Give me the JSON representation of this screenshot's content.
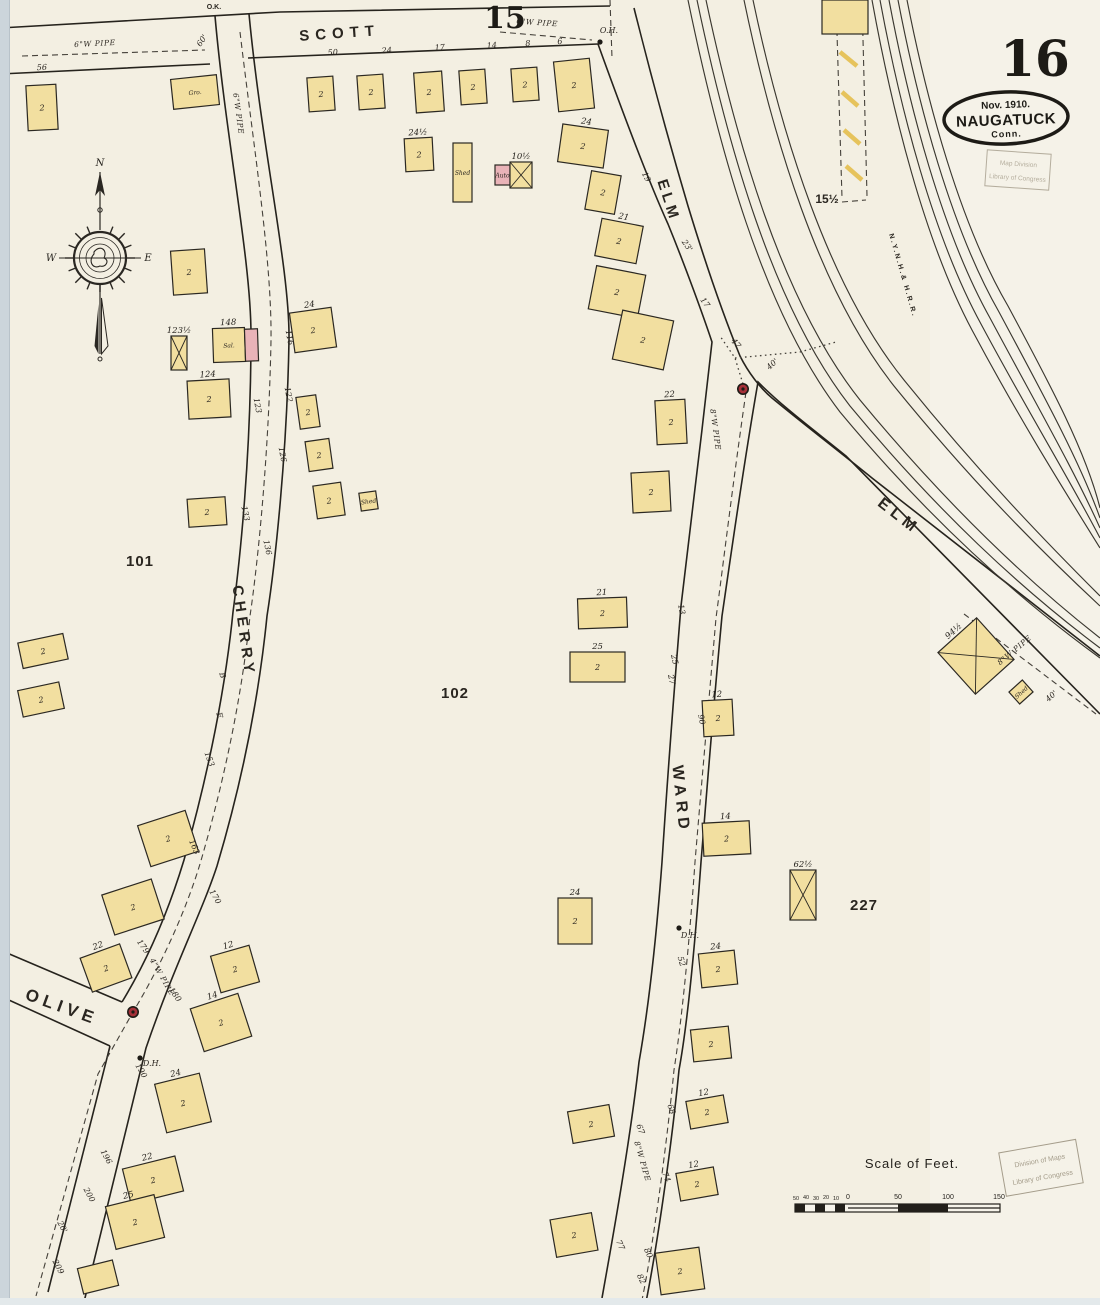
{
  "sheet": {
    "number": "16",
    "adjacent_top": "15",
    "adjacent_right_block": "15½",
    "corner_note": "O.K."
  },
  "publisher_oval": {
    "date": "Nov. 1910.",
    "city": "NAUGATUCK",
    "state": "Conn."
  },
  "stamps": {
    "top": {
      "line1": "Map Division",
      "line2": "Library of Congress"
    },
    "bottom": {
      "line1": "Division of Maps",
      "line2": "Library of Congress"
    }
  },
  "scale_bar": {
    "title": "Scale of Feet.",
    "ticks": [
      "50",
      "40",
      "30",
      "20",
      "10",
      "0",
      "50",
      "100",
      "150"
    ]
  },
  "compass": {
    "north": "N",
    "west": "W",
    "east": "E"
  },
  "colors": {
    "paper": "#f3efe2",
    "paper_light": "#f6f3ea",
    "frame_yellow": "#f2dfa0",
    "brick_pink": "#e9b3b8",
    "hydrant_red": "#a53038",
    "ink": "#26231d",
    "hatch_yellow": "#e6c35c",
    "edge_strip": "#ccd5db",
    "stamp_ink": "#a59d8b"
  },
  "map": {
    "block_numbers": [
      "101",
      "102",
      "227"
    ],
    "street_names": [
      "SCOTT",
      "CHERRY",
      "ELM",
      "WARD",
      "OLIVE"
    ],
    "railroad_name": "N.Y.N.H.& H.R.R.",
    "lines": [
      {
        "n": "sheet-15-edge-line",
        "c": "st",
        "d": "M0,28 L280,12 L610,6"
      },
      {
        "n": "scott-south-edge",
        "c": "st",
        "d": "M0,74 L210,64 M248,58 L598,44"
      },
      {
        "n": "cherry-west-edge",
        "c": "st",
        "d": "M215,16 C226,140 251,260 251,335 C251,455 240,560 233,612 C225,692 207,778 184,860 C170,906 150,956 122,1002"
      },
      {
        "n": "cherry-west-edge-lower",
        "c": "st",
        "d": "M110,1046 L48,1292"
      },
      {
        "n": "cherry-east-edge",
        "c": "st",
        "d": "M249,14 C262,150 290,270 289,340 C287,455 275,565 267,616 C259,696 242,782 217,866 C202,912 174,966 146,1048 L84,1302"
      },
      {
        "n": "olive-north-edge",
        "c": "st",
        "d": "M0,950 L122,1002"
      },
      {
        "n": "olive-south-edge",
        "c": "st",
        "d": "M0,996 L110,1046"
      },
      {
        "n": "elm-west-ward-west-edge",
        "c": "st",
        "d": "M598,44 C620,105 648,180 668,224 C686,268 704,318 712,342 C702,432 688,548 681,606 C672,716 666,800 662,862 C655,956 646,1022 639,1062 C630,1142 612,1242 602,1298"
      },
      {
        "n": "elm-east-edge",
        "c": "st",
        "d": "M634,8 C652,80 672,152 688,206 C702,252 722,312 740,356 C748,372 760,388 772,398 C806,426 840,452 872,478 L1100,656"
      },
      {
        "n": "elm-southwest-ward-east-edge",
        "c": "st",
        "d": "M1100,714 L846,456 C814,430 784,408 758,382 C742,474 730,562 722,616 C712,722 706,802 701,862 C694,958 686,1032 679,1070 C671,1152 656,1252 646,1302"
      },
      {
        "n": "rail-track",
        "c": "rail",
        "d": "M688,0 C718,145 762,310 840,412 C930,520 1015,596 1100,658"
      },
      {
        "n": "rail-track",
        "c": "rail",
        "d": "M697,0 C727,143 772,306 850,406 C938,512 1020,588 1100,648"
      },
      {
        "n": "rail-track",
        "c": "rail",
        "d": "M706,0 C736,141 782,302 860,400 C946,504 1026,580 1100,638"
      },
      {
        "n": "rail-track",
        "c": "rail",
        "d": "M744,0 C772,135 818,290 894,386 C972,482 1040,550 1100,606"
      },
      {
        "n": "rail-track",
        "c": "rail",
        "d": "M753,0 C781,133 828,286 904,380 C980,474 1046,542 1100,596"
      },
      {
        "n": "rail-track",
        "c": "rail",
        "d": "M872,0 C892,110 924,240 972,330 C1020,420 1064,490 1100,548"
      },
      {
        "n": "rail-track",
        "c": "rail",
        "d": "M880,0 C900,108 933,236 981,324 C1028,412 1070,480 1100,538"
      },
      {
        "n": "rail-track",
        "c": "rail",
        "d": "M889,0 C909,106 942,232 990,318 C1036,404 1074,470 1100,528"
      },
      {
        "n": "rail-track",
        "c": "rail",
        "d": "M898,0 C918,104 951,228 999,312 C1044,396 1080,462 1100,518"
      },
      {
        "n": "rail-track",
        "c": "rail",
        "d": "M907,0 C927,102 960,224 1008,306 C1052,388 1086,452 1100,508"
      },
      {
        "n": "water-pipe",
        "c": "pipe",
        "d": "M22,56 L205,50"
      },
      {
        "n": "water-pipe",
        "c": "pipe",
        "d": "M500,32 L592,40"
      },
      {
        "n": "water-pipe-cherry",
        "c": "pipe",
        "d": "M240,32 C254,150 272,262 271,340 C269,452 258,562 250,616 C242,696 224,782 200,864 C186,910 162,964 133,1012 L98,1074 L36,1296"
      },
      {
        "n": "water-pipe-ward",
        "c": "pipe",
        "d": "M746,392 C733,482 723,566 716,618 C707,722 700,802 695,862 C688,962 680,1032 674,1070 C666,1152 652,1252 642,1300"
      },
      {
        "n": "water-pipe-elm",
        "c": "pipe",
        "d": "M964,614 L1096,714"
      },
      {
        "n": "dotted-line",
        "c": "dotl",
        "d": "M743,384 L735,358 L720,336"
      },
      {
        "n": "dotted-line",
        "c": "dotl",
        "d": "M735,358 L800,352 L836,342"
      },
      {
        "n": "trestle-dashed-edge",
        "c": "pipe",
        "d": "M836,0 L842,198"
      },
      {
        "n": "trestle-dashed-edge",
        "c": "pipe",
        "d": "M862,0 L867,196 M842,202 L866,200"
      },
      {
        "n": "dashed-line-top",
        "c": "pipe",
        "d": "M610,0 L612,58"
      }
    ],
    "trestle_hatches": [
      [
        839,
        14,
        856,
        28
      ],
      [
        840,
        52,
        857,
        66
      ],
      [
        842,
        92,
        858,
        106
      ],
      [
        844,
        130,
        860,
        144
      ],
      [
        846,
        166,
        862,
        180
      ]
    ],
    "buildings": [
      {
        "x": 27,
        "y": 85,
        "w": 30,
        "h": 45,
        "r": -3,
        "s": "2"
      },
      {
        "x": 172,
        "y": 77,
        "w": 46,
        "h": 30,
        "r": -6,
        "li": "Gro."
      },
      {
        "x": 308,
        "y": 77,
        "w": 26,
        "h": 34,
        "r": -4,
        "s": "2"
      },
      {
        "x": 358,
        "y": 75,
        "w": 26,
        "h": 34,
        "r": -4,
        "s": "2"
      },
      {
        "x": 415,
        "y": 72,
        "w": 28,
        "h": 40,
        "r": -4,
        "s": "2"
      },
      {
        "x": 460,
        "y": 70,
        "w": 26,
        "h": 34,
        "r": -4,
        "s": "2"
      },
      {
        "x": 512,
        "y": 68,
        "w": 26,
        "h": 33,
        "r": -4,
        "s": "2"
      },
      {
        "x": 556,
        "y": 60,
        "w": 36,
        "h": 50,
        "r": -6,
        "s": "2"
      },
      {
        "x": 822,
        "y": 0,
        "w": 46,
        "h": 34,
        "r": 0
      },
      {
        "x": 405,
        "y": 138,
        "w": 28,
        "h": 33,
        "r": -3,
        "lb": "24½",
        "s": "2"
      },
      {
        "x": 453,
        "y": 143,
        "w": 19,
        "h": 59,
        "r": 0,
        "li": "Shed"
      },
      {
        "x": 495,
        "y": 165,
        "w": 15,
        "h": 20,
        "r": 0,
        "p": 1,
        "li": "Auto"
      },
      {
        "x": 510,
        "y": 162,
        "w": 22,
        "h": 26,
        "r": 0,
        "xm": 1,
        "lb": "10½"
      },
      {
        "x": 560,
        "y": 127,
        "w": 46,
        "h": 38,
        "r": 8,
        "s": "2",
        "lb": "24"
      },
      {
        "x": 588,
        "y": 173,
        "w": 30,
        "h": 39,
        "r": 10,
        "s": "2"
      },
      {
        "x": 598,
        "y": 222,
        "w": 42,
        "h": 38,
        "r": 11,
        "s": "2",
        "lb": "21"
      },
      {
        "x": 592,
        "y": 270,
        "w": 50,
        "h": 44,
        "r": 11,
        "s": "2"
      },
      {
        "x": 617,
        "y": 315,
        "w": 52,
        "h": 50,
        "r": 12,
        "s": "2"
      },
      {
        "x": 656,
        "y": 400,
        "w": 30,
        "h": 44,
        "r": -3,
        "s": "2",
        "lb": "22"
      },
      {
        "x": 632,
        "y": 472,
        "w": 38,
        "h": 40,
        "r": -3,
        "s": "2"
      },
      {
        "x": 172,
        "y": 250,
        "w": 34,
        "h": 44,
        "r": -4,
        "s": "2"
      },
      {
        "x": 171,
        "y": 336,
        "w": 16,
        "h": 34,
        "r": 0,
        "xm": 1,
        "lb": "123½"
      },
      {
        "x": 213,
        "y": 328,
        "w": 32,
        "h": 34,
        "r": -2,
        "li": "Sal.",
        "lb": "148"
      },
      {
        "x": 245,
        "y": 329,
        "w": 13,
        "h": 32,
        "r": -2,
        "p": 1
      },
      {
        "x": 188,
        "y": 380,
        "w": 42,
        "h": 38,
        "r": -3,
        "s": "2",
        "lb": "124"
      },
      {
        "x": 188,
        "y": 498,
        "w": 38,
        "h": 28,
        "r": -4,
        "s": "2"
      },
      {
        "x": 292,
        "y": 310,
        "w": 42,
        "h": 40,
        "r": -8,
        "s": "2",
        "lb": "24"
      },
      {
        "x": 298,
        "y": 396,
        "w": 20,
        "h": 32,
        "r": -8,
        "s": "2"
      },
      {
        "x": 307,
        "y": 440,
        "w": 24,
        "h": 30,
        "r": -8,
        "s": "2"
      },
      {
        "x": 315,
        "y": 484,
        "w": 28,
        "h": 33,
        "r": -8,
        "s": "2"
      },
      {
        "x": 360,
        "y": 492,
        "w": 17,
        "h": 18,
        "r": -8,
        "li": "Shed"
      },
      {
        "x": 578,
        "y": 598,
        "w": 49,
        "h": 30,
        "r": -2,
        "s": "2",
        "lb": "21"
      },
      {
        "x": 570,
        "y": 652,
        "w": 55,
        "h": 30,
        "r": 0,
        "s": "2",
        "lb": "25"
      },
      {
        "x": 703,
        "y": 700,
        "w": 30,
        "h": 36,
        "r": -3,
        "s": "2",
        "lb": "12"
      },
      {
        "x": 703,
        "y": 822,
        "w": 47,
        "h": 33,
        "r": -3,
        "s": "2",
        "lb": "14"
      },
      {
        "x": 790,
        "y": 870,
        "w": 26,
        "h": 50,
        "r": 0,
        "xm": 1,
        "lb": "62½"
      },
      {
        "x": 558,
        "y": 898,
        "w": 34,
        "h": 46,
        "r": 0,
        "s": "2",
        "lb": "24"
      },
      {
        "x": 700,
        "y": 952,
        "w": 36,
        "h": 34,
        "r": -6,
        "s": "2",
        "lb": "24"
      },
      {
        "x": 692,
        "y": 1028,
        "w": 38,
        "h": 32,
        "r": -6,
        "s": "2"
      },
      {
        "x": 688,
        "y": 1098,
        "w": 38,
        "h": 28,
        "r": -10,
        "s": "2",
        "lb": "12"
      },
      {
        "x": 678,
        "y": 1170,
        "w": 38,
        "h": 28,
        "r": -10,
        "s": "2",
        "lb": "12"
      },
      {
        "x": 658,
        "y": 1250,
        "w": 44,
        "h": 42,
        "r": -8,
        "s": "2"
      },
      {
        "x": 570,
        "y": 1108,
        "w": 42,
        "h": 32,
        "r": -10,
        "s": "2"
      },
      {
        "x": 553,
        "y": 1216,
        "w": 42,
        "h": 38,
        "r": -10,
        "s": "2"
      },
      {
        "x": 20,
        "y": 638,
        "w": 46,
        "h": 26,
        "r": -12,
        "s": "2"
      },
      {
        "x": 20,
        "y": 686,
        "w": 42,
        "h": 27,
        "r": -12,
        "s": "2"
      },
      {
        "x": 143,
        "y": 817,
        "w": 50,
        "h": 43,
        "r": -18,
        "s": "2"
      },
      {
        "x": 107,
        "y": 886,
        "w": 52,
        "h": 42,
        "r": -18,
        "s": "2"
      },
      {
        "x": 85,
        "y": 950,
        "w": 42,
        "h": 36,
        "r": -20,
        "s": "2",
        "lb": "22"
      },
      {
        "x": 215,
        "y": 950,
        "w": 40,
        "h": 38,
        "r": -16,
        "s": "2",
        "lb": "12"
      },
      {
        "x": 196,
        "y": 1000,
        "w": 50,
        "h": 45,
        "r": -18,
        "s": "2",
        "lb": "14"
      },
      {
        "x": 160,
        "y": 1078,
        "w": 46,
        "h": 50,
        "r": -14,
        "s": "2",
        "lb": "24"
      },
      {
        "x": 126,
        "y": 1162,
        "w": 54,
        "h": 36,
        "r": -14,
        "s": "2",
        "lb": "22"
      },
      {
        "x": 110,
        "y": 1200,
        "w": 50,
        "h": 44,
        "r": -14,
        "s": "2",
        "lb": "25"
      },
      {
        "x": 80,
        "y": 1264,
        "w": 36,
        "h": 26,
        "r": -14
      },
      {
        "x": 950,
        "y": 628,
        "w": 52,
        "h": 56,
        "r": -42,
        "xm": 1,
        "lb": "94½"
      },
      {
        "x": 1012,
        "y": 684,
        "w": 18,
        "h": 16,
        "r": -42,
        "li": "Shed"
      }
    ],
    "street_numbers": [
      [
        "56",
        42,
        70,
        -3
      ],
      [
        "50",
        333,
        55,
        -4
      ],
      [
        "24",
        387,
        53,
        -4
      ],
      [
        "17",
        440,
        50,
        -4
      ],
      [
        "14",
        492,
        48,
        -4
      ],
      [
        "8",
        528,
        46,
        -4
      ],
      [
        "6",
        560,
        44,
        -4
      ],
      [
        "O.H.",
        609,
        33,
        0
      ],
      [
        "60'",
        204,
        42,
        -55
      ],
      [
        "116",
        287,
        338,
        80
      ],
      [
        "122",
        286,
        395,
        80
      ],
      [
        "126",
        280,
        455,
        80
      ],
      [
        "136",
        265,
        548,
        78
      ],
      [
        "123",
        255,
        406,
        80
      ],
      [
        "133",
        243,
        514,
        78
      ],
      [
        "B",
        220,
        676,
        75
      ],
      [
        "E",
        217,
        716,
        75
      ],
      [
        "153",
        207,
        760,
        70
      ],
      [
        "163",
        192,
        848,
        66
      ],
      [
        "170",
        213,
        898,
        60
      ],
      [
        "179",
        141,
        948,
        55
      ],
      [
        "180",
        173,
        996,
        55
      ],
      [
        "190",
        139,
        1072,
        60
      ],
      [
        "196",
        104,
        1158,
        62
      ],
      [
        "200",
        87,
        1196,
        62
      ],
      [
        "20'",
        60,
        1228,
        62
      ],
      [
        "209",
        56,
        1268,
        62
      ],
      [
        "90",
        699,
        720,
        78
      ],
      [
        "13",
        679,
        610,
        78
      ],
      [
        "25",
        672,
        660,
        78
      ],
      [
        "27",
        669,
        680,
        78
      ],
      [
        "52",
        679,
        962,
        74
      ],
      [
        "68",
        669,
        1110,
        70
      ],
      [
        "67",
        638,
        1130,
        70
      ],
      [
        "74",
        664,
        1178,
        68
      ],
      [
        "77",
        618,
        1246,
        66
      ],
      [
        "80",
        646,
        1254,
        66
      ],
      [
        "82",
        639,
        1280,
        66
      ],
      [
        "19",
        644,
        178,
        62
      ],
      [
        "23'",
        685,
        247,
        56
      ],
      [
        "17",
        703,
        304,
        54
      ],
      [
        "47",
        734,
        345,
        50
      ],
      [
        "40'",
        774,
        366,
        -42
      ],
      [
        "40'",
        1053,
        698,
        -42
      ],
      [
        "D.H.",
        152,
        1066,
        0
      ],
      [
        "D.H.",
        690,
        938,
        0
      ]
    ],
    "pipe_labels": [
      [
        "6\"W PIPE",
        95,
        46,
        -3
      ],
      [
        "6\"W PIPE",
        537,
        25,
        4
      ],
      [
        "6\"W PIPE",
        236,
        114,
        82
      ],
      [
        "4\"W PIPE",
        160,
        978,
        60
      ],
      [
        "8\"W PIPE",
        713,
        430,
        82
      ],
      [
        "8\"W PIPE",
        640,
        1162,
        74
      ],
      [
        "8\"W PIPE",
        1016,
        652,
        -40
      ]
    ],
    "labels": [
      {
        "t": "SCOTT",
        "x": 340,
        "y": 38,
        "r": -4,
        "fs": 15,
        "ls": 6
      },
      {
        "t": "CHERRY",
        "x": 239,
        "y": 632,
        "r": 82,
        "fs": 15,
        "ls": 5
      },
      {
        "t": "ELM",
        "x": 664,
        "y": 202,
        "r": 72,
        "fs": 15,
        "ls": 4
      },
      {
        "t": "ELM",
        "x": 896,
        "y": 520,
        "r": 38,
        "fs": 16,
        "ls": 5
      },
      {
        "t": "WARD",
        "x": 676,
        "y": 800,
        "r": 84,
        "fs": 16,
        "ls": 5
      },
      {
        "t": "OLIVE",
        "x": 60,
        "y": 1012,
        "r": 20,
        "fs": 17,
        "ls": 5
      },
      {
        "t": "101",
        "x": 140,
        "y": 566,
        "r": 0,
        "fs": 15,
        "ls": 1
      },
      {
        "t": "102",
        "x": 455,
        "y": 698,
        "r": 0,
        "fs": 15,
        "ls": 1
      },
      {
        "t": "227",
        "x": 864,
        "y": 910,
        "r": 0,
        "fs": 15,
        "ls": 1
      },
      {
        "t": "15½",
        "x": 827,
        "y": 203,
        "r": 0,
        "fs": 12,
        "ls": 0
      },
      {
        "t": "O.K.",
        "x": 214,
        "y": 9,
        "r": 0,
        "fs": 7,
        "ls": 0
      },
      {
        "t": "N.Y.N.H.& H.R.R.",
        "x": 901,
        "y": 276,
        "r": 74,
        "fs": 7,
        "ls": 2
      }
    ],
    "hydrants": [
      [
        133,
        1012
      ],
      [
        743,
        389
      ]
    ],
    "marker_dots": [
      [
        600,
        42
      ],
      [
        140,
        1058
      ],
      [
        679,
        928
      ]
    ]
  }
}
